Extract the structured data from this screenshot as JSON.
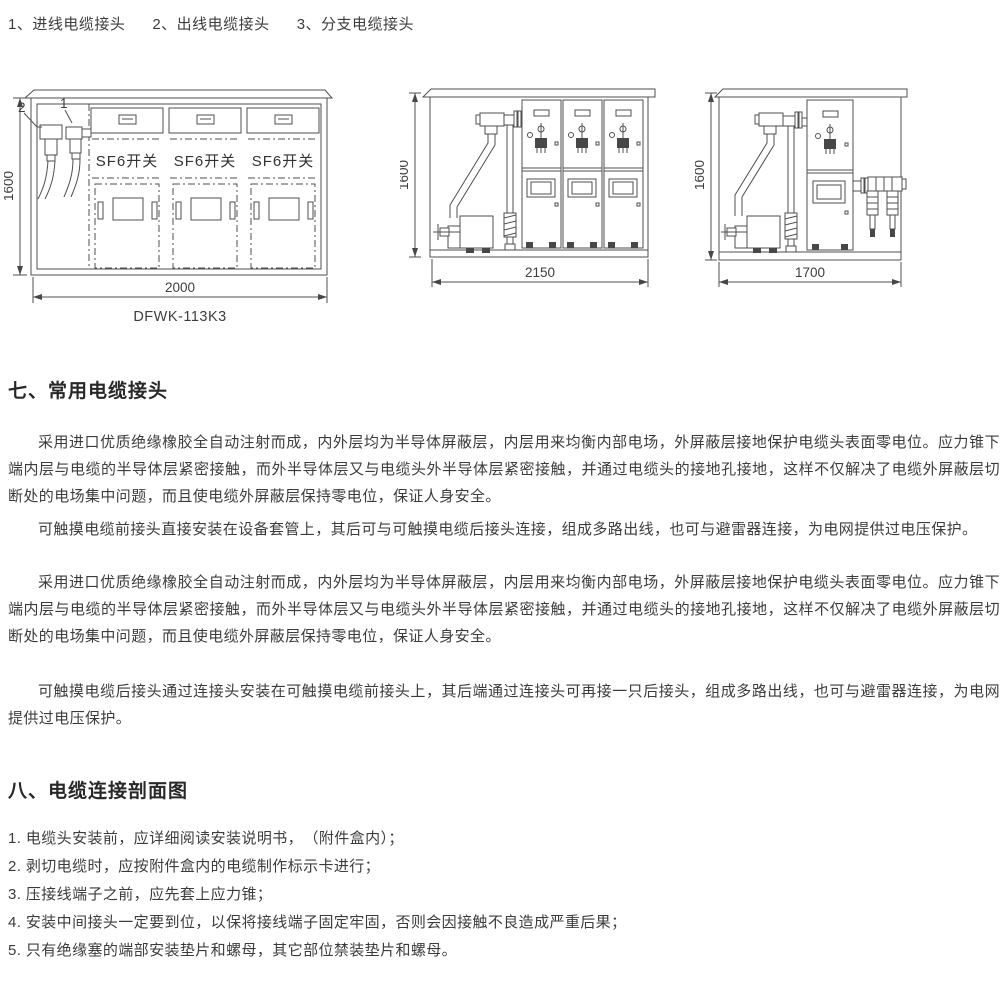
{
  "legend": {
    "items": [
      "1、进线电缆接头",
      "2、出线电缆接头",
      "3、分支电缆接头"
    ]
  },
  "figures": {
    "front_view": {
      "callout_2": "2",
      "callout_1": "1",
      "panel_label": "SF6开关",
      "height_dim": "1600",
      "width_dim": "2000",
      "model": "DFWK-113K3"
    },
    "section_view": {
      "height_dim": "1600",
      "width_dim": "2150"
    },
    "single_bay_view": {
      "height_dim": "1600",
      "width_dim": "1700"
    }
  },
  "section_common_joints": {
    "title": "七、常用电缆接头",
    "paragraphs": [
      "采用进口优质绝缘橡胶全自动注射而成，内外层均为半导体屏蔽层，内层用来均衡内部电场，外屏蔽层接地保护电缆头表面零电位。应力锥下端内层与电缆的半导体层紧密接触，而外半导体层又与电缆头外半导体层紧密接触，并通过电缆头的接地孔接地，这样不仅解决了电缆外屏蔽层切断处的电场集中问题，而且使电缆外屏蔽层保持零电位，保证人身安全。",
      "可触摸电缆前接头直接安装在设备套管上，其后可与可触摸电缆后接头连接，组成多路出线，也可与避雷器连接，为电网提供过电压保护。",
      "采用进口优质绝缘橡胶全自动注射而成，内外层均为半导体屏蔽层，内层用来均衡内部电场，外屏蔽层接地保护电缆头表面零电位。应力锥下端内层与电缆的半导体层紧密接触，而外半导体层又与电缆头外半导体层紧密接触，并通过电缆头的接地孔接地，这样不仅解决了电缆外屏蔽层切断处的电场集中问题，而且使电缆外屏蔽层保持零电位，保证人身安全。",
      "可触摸电缆后接头通过连接头安装在可触摸电缆前接头上，其后端通过连接头可再接一只后接头，组成多路出线，也可与避雷器连接，为电网提供过电压保护。"
    ]
  },
  "section_profile": {
    "title": "八、电缆连接剖面图",
    "items": [
      "1. 电缆头安装前，应详细阅读安装说明书，　（附件盒内）；",
      "2. 剥切电缆时，应按附件盒内的电缆制作标示卡进行；",
      "3. 压接线端子之前，应先套上应力锥；",
      "4. 安装中间接头一定要到位，以保将接线端子固定牢固，否则会因接触不良造成严重后果；",
      "5. 只有绝缘塞的端部安装垫片和螺母，其它部位禁装垫片和螺母。"
    ]
  }
}
